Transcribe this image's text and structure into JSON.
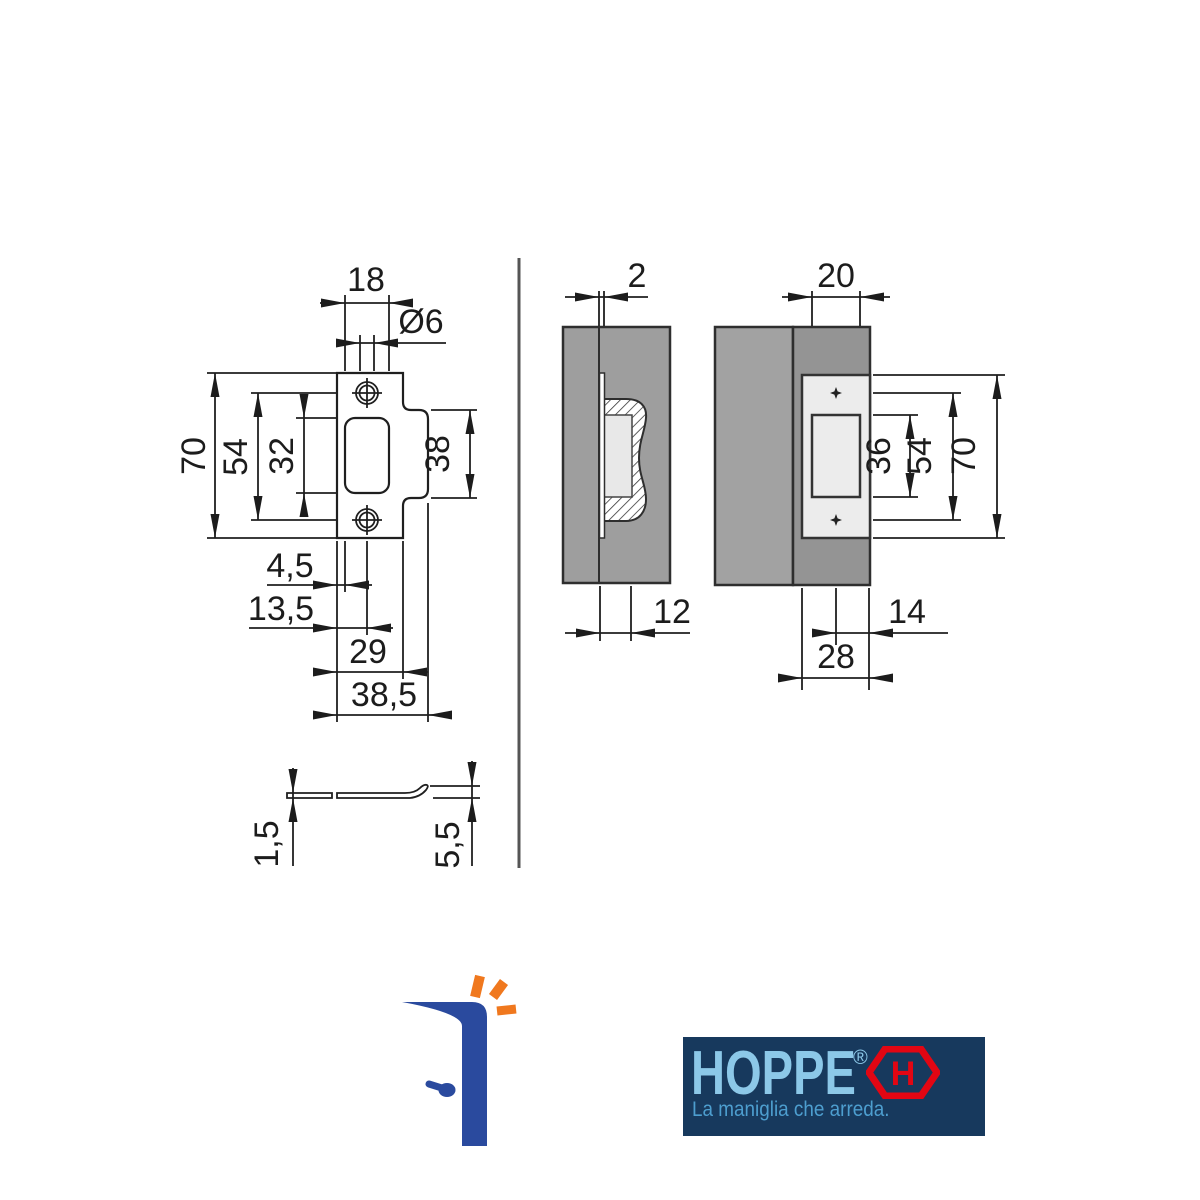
{
  "dims": {
    "front": {
      "width": "18",
      "hole": "Ø6",
      "height": "70",
      "screws": "54",
      "opening": "32",
      "tab": "38",
      "d45": "4,5",
      "d135": "13,5",
      "d29": "29",
      "d385": "38,5"
    },
    "section": {
      "thickness": "2",
      "depth": "12"
    },
    "side": {
      "top": "20",
      "opening": "36",
      "screws": "54",
      "height": "70",
      "d14": "14",
      "d28": "28"
    },
    "profile": {
      "thickness": "1,5",
      "lip": "5,5"
    }
  },
  "branding": {
    "logo_text": "HOPPE",
    "registered": "®",
    "hexagon_letter": "H",
    "tagline": "La maniglia che arreda.",
    "colors": {
      "navy": "#17395d",
      "light_blue": "#8cc8e8",
      "tagline_blue": "#4d9ecf",
      "red": "#e20613",
      "icon_blue": "#2a4a9e",
      "icon_orange": "#f0781e"
    }
  }
}
